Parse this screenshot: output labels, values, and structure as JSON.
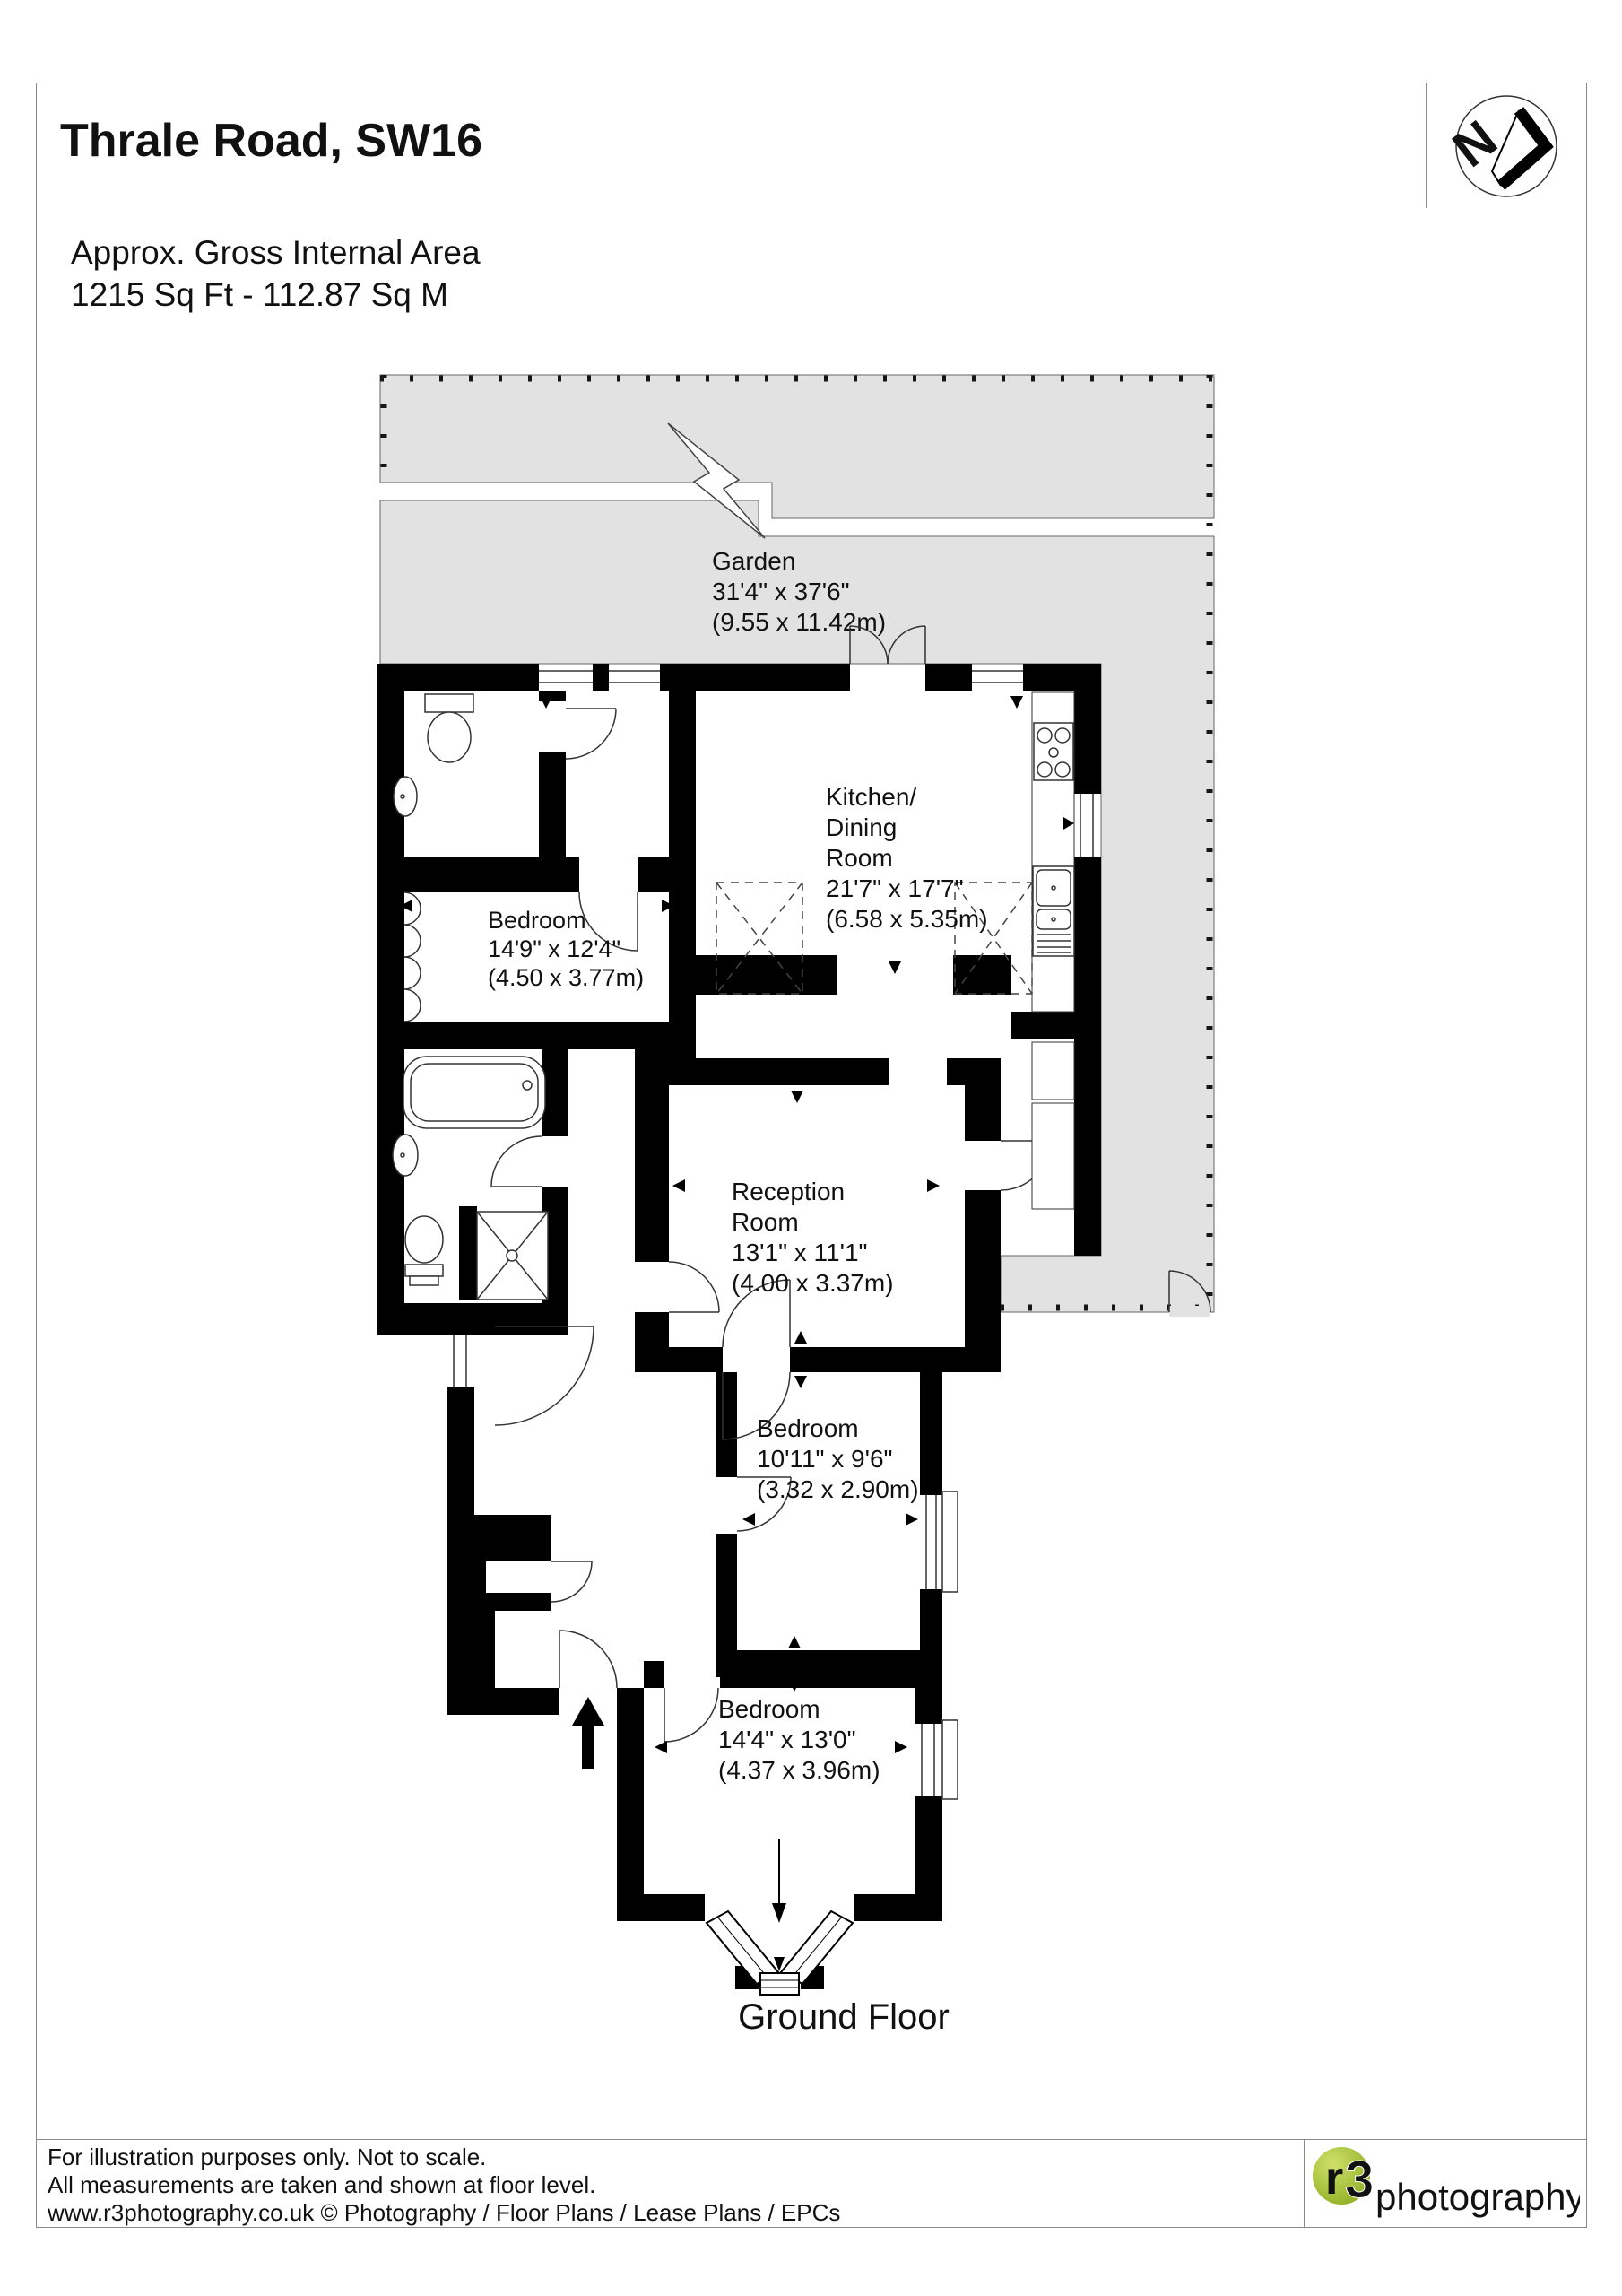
{
  "page": {
    "title": "Thrale Road, SW16"
  },
  "area_summary": {
    "line1": "Approx. Gross Internal Area",
    "line2": "1215 Sq Ft  -  112.87 Sq M"
  },
  "compass": {
    "letter": "N"
  },
  "plan": {
    "floor_label": "Ground Floor",
    "garden": {
      "lines": [
        "Garden",
        "31'4\" x 37'6\"",
        "(9.55 x 11.42m)"
      ]
    },
    "kitchen": {
      "lines": [
        "Kitchen/",
        "Dining",
        "Room",
        "21'7\" x 17'7\"",
        "(6.58 x 5.35m)"
      ]
    },
    "bedroom1": {
      "lines": [
        "Bedroom",
        "14'9\" x 12'4\"",
        "(4.50 x 3.77m)"
      ]
    },
    "reception": {
      "lines": [
        "Reception",
        "Room",
        "13'1\" x 11'1\"",
        "(4.00 x 3.37m)"
      ]
    },
    "bedroom2": {
      "lines": [
        "Bedroom",
        "10'11\" x 9'6\"",
        "(3.32 x 2.90m)"
      ]
    },
    "bedroom3": {
      "lines": [
        "Bedroom",
        "14'4\" x 13'0\"",
        "(4.37 x 3.96m)"
      ]
    }
  },
  "footer": {
    "line1": "For illustration purposes only. Not to scale.",
    "line2": "All measurements are taken and shown at floor level.",
    "line3": "www.r3photography.co.uk © Photography / Floor Plans / Lease Plans / EPCs"
  },
  "logo": {
    "circle_letter": "r",
    "circle_digit": "3",
    "wordmark": "photography"
  },
  "colors": {
    "garden_fill": "#e2e2e2",
    "wall": "#000000",
    "logo_green": "#9cb832",
    "logo_green_dark": "#85a62c"
  }
}
